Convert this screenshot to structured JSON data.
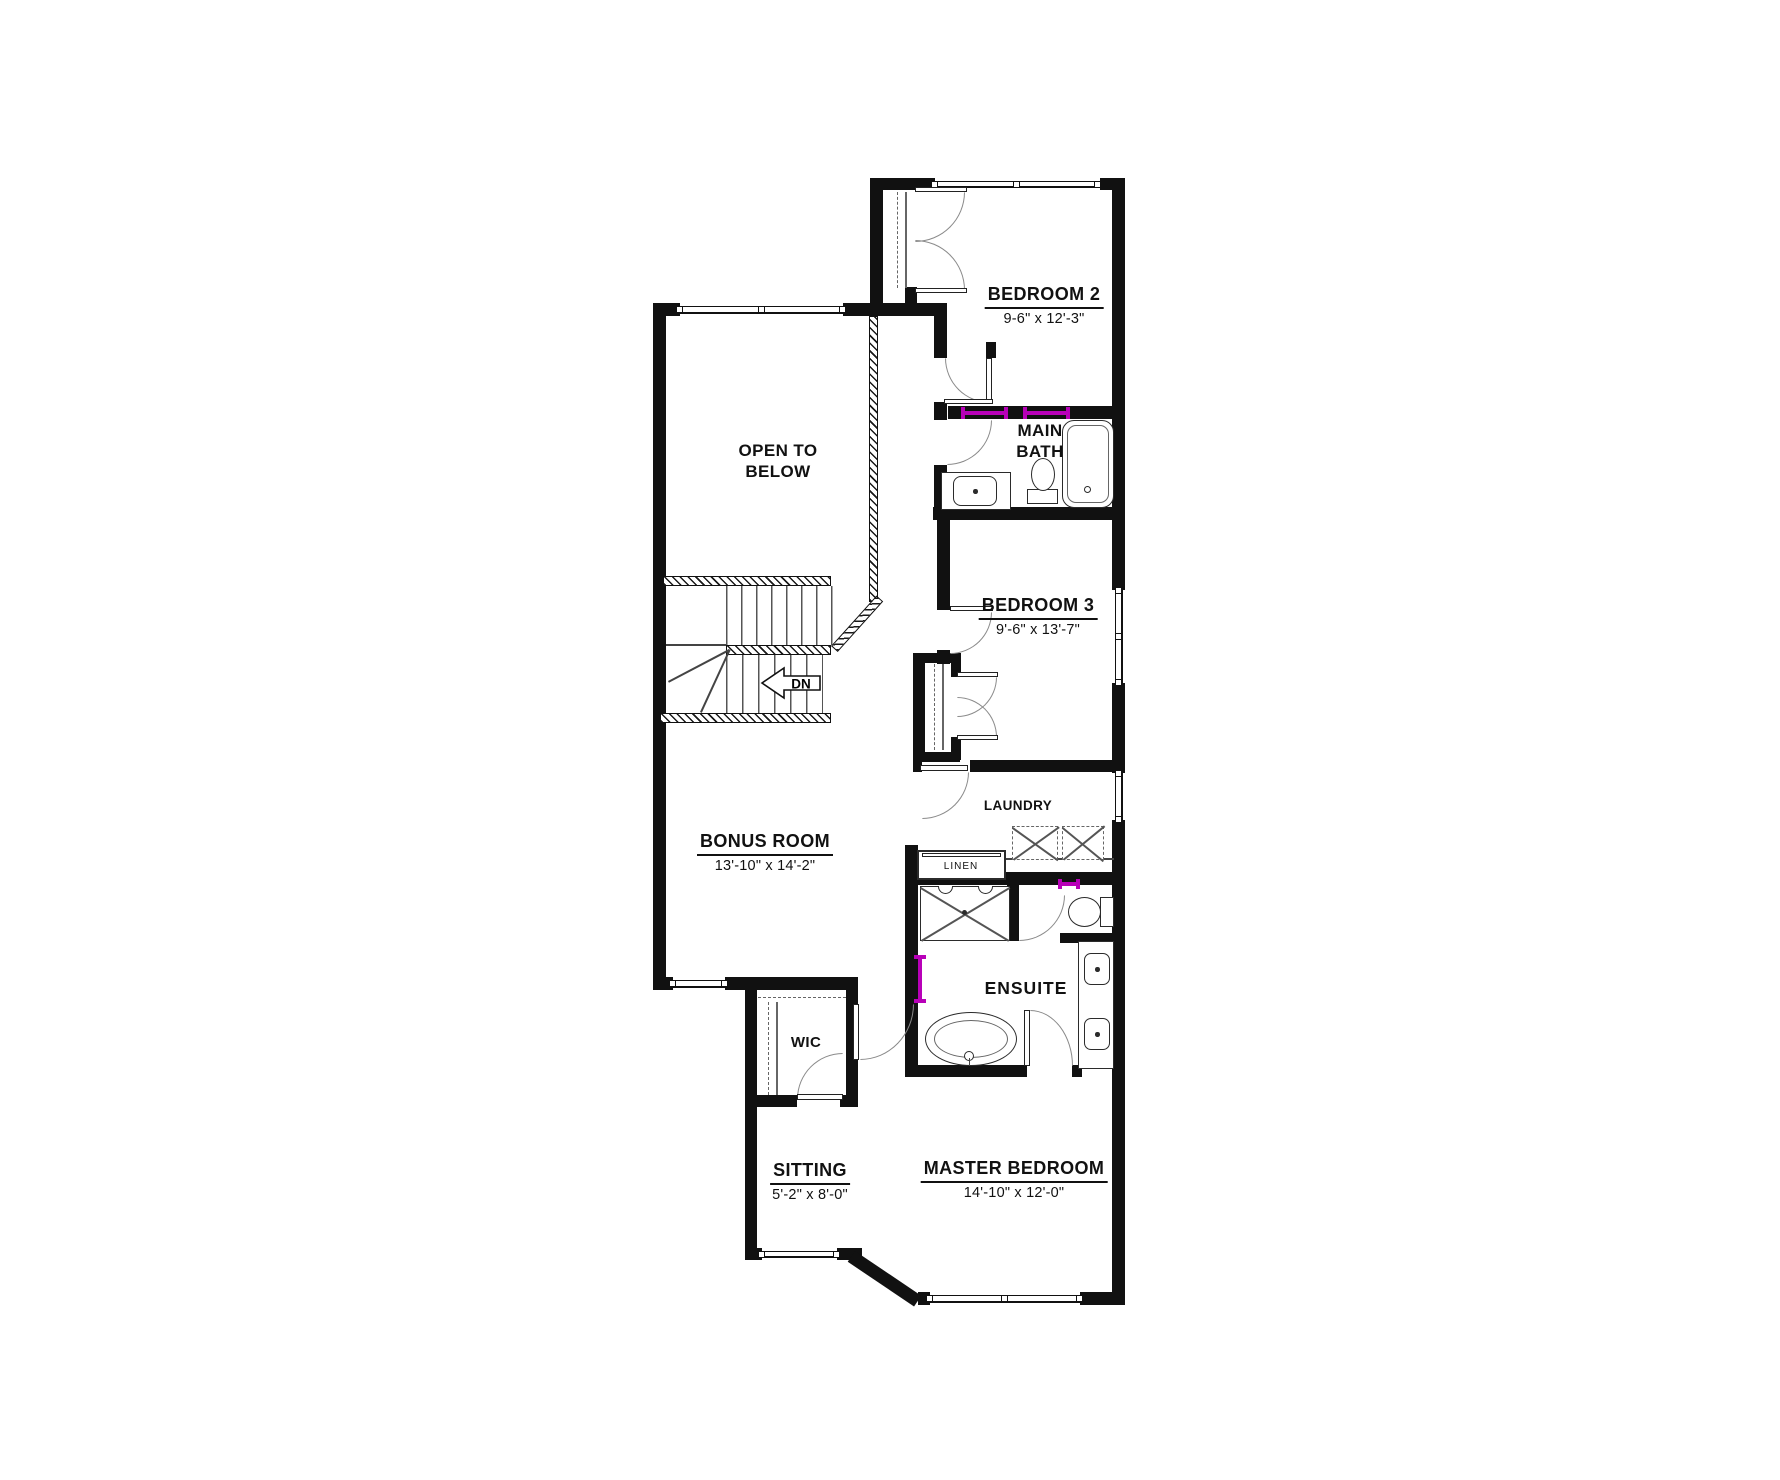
{
  "title": "Second Floor Plan",
  "rooms": {
    "bedroom_2": {
      "name": "BEDROOM 2",
      "dimensions": "9-6\" x 12'-3\""
    },
    "main_bath": {
      "name_line1": "MAIN",
      "name_line2": "BATH"
    },
    "open_to_below": {
      "name_line1": "OPEN TO",
      "name_line2": "BELOW"
    },
    "bedroom_3": {
      "name": "BEDROOM 3",
      "dimensions": "9'-6\" x 13'-7\""
    },
    "laundry": {
      "name": "LAUNDRY"
    },
    "linen": {
      "name": "LINEN"
    },
    "bonus_room": {
      "name": "BONUS ROOM",
      "dimensions": "13'-10\" x 14'-2\""
    },
    "wic": {
      "name": "WIC"
    },
    "ensuite": {
      "name": "ENSUITE"
    },
    "sitting": {
      "name": "SITTING",
      "dimensions": "5'-2\" x 8'-0\""
    },
    "master_bedroom": {
      "name": "MASTER BEDROOM",
      "dimensions": "14'-10\" x 12'-0\""
    }
  },
  "stairs": {
    "down_label": "DN"
  },
  "colors": {
    "wall": "#111111",
    "accent": "#b800b8"
  }
}
